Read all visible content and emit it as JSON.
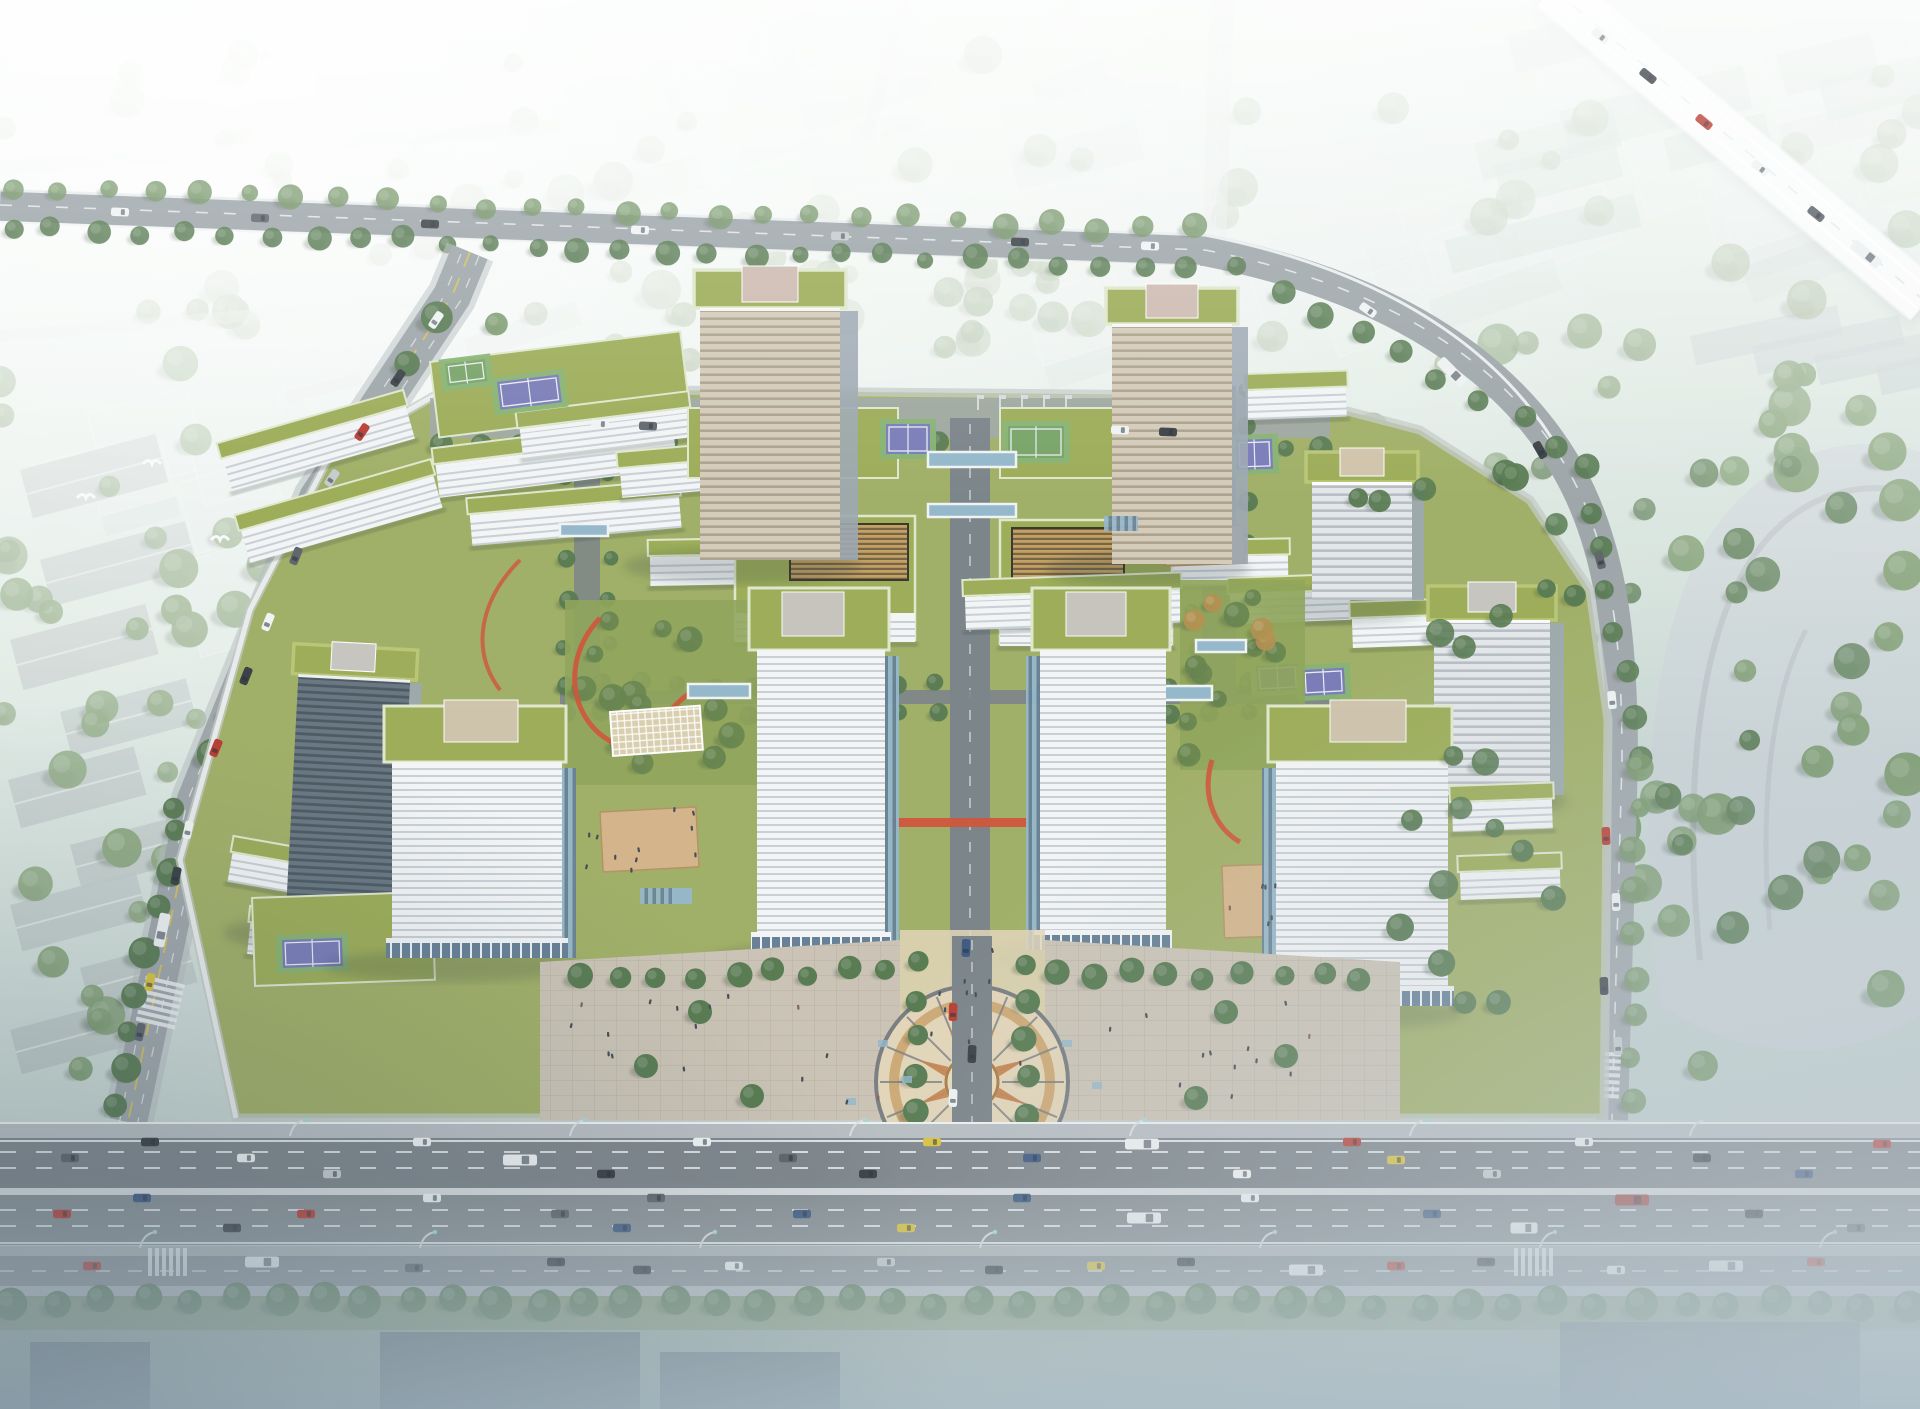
{
  "meta": {
    "description": "Aerial architectural rendering of a green-roofed research campus: two striped high-rise towers at the north, four cubic office blocks around a central paved plaza with a circular compass pattern, low-rise white banded buildings with rooftop lawns, sports courts and red jogging tracks, surrounded by tree-lined roads, a hazy white low-rise city, an elevated expressway at the top right and a wide multi-lane boulevard full of traffic across the bottom"
  },
  "palette": {
    "bgTop": "#e9f3ee",
    "bgMid": "#d3e2da",
    "bgLow": "#c3d2cf",
    "hazeWhite": "#ffffff",
    "boxFill": "#dfe9e8",
    "boxEdge": "#f6fafa",
    "boxShade": "#b9c6c7",
    "gableFill": "#b4bfbe",
    "glassSlab": "#aec6bb",
    "treeBg": "#8aa57d",
    "treeMid": "#6f9160",
    "treeDark": "#4e7247",
    "treeOlive": "#7e9a55",
    "treeOrange": "#b08a46",
    "fieldGreen": "#c7d8c0",
    "roadFaint": "#cdd6d4",
    "roadMain": "#9aa1a6",
    "roadDark": "#7e868c",
    "asphaltA": "#787f86",
    "asphaltB": "#82898f",
    "median": "#abb2b7",
    "sidewalk": "#b5bbc0",
    "frontage": "#868d93",
    "laneWhite": "#e9eef2",
    "laneYellow": "#d9c04b",
    "rail": "#f2f5f6",
    "campusGreen": "#9cab5e",
    "roofGreen": "#97a84e",
    "roofGreenL": "#b6c36e",
    "fascia": "#dfe7cb",
    "lawn": "#8aa051",
    "gardenDark": "#5e7c44",
    "slabWhite": "#f3f5f7",
    "slabShadow": "#c6cdd4",
    "slabSide": "#d8dde2",
    "towerTanA": "#d3c8b6",
    "towerTanB": "#a99c88",
    "towerSide": "#97a2ae",
    "darkA": "#5f6e7a",
    "darkB": "#424f59",
    "towerGreyA": "#e4e7ea",
    "towerGreyB": "#b3bac2",
    "penthousePink": "#cbb7ad",
    "penthouseGrey": "#c5c2bd",
    "penthouseTan": "#cfc0a8",
    "glassBlue": "#8fb3c9",
    "glassDark": "#5e7890",
    "mullion": "#eef4f8",
    "courtBlue": "#7173b5",
    "courtGreen": "#7fae6c",
    "courtLine": "#e8ecf2",
    "deckTan": "#d3b084",
    "trackRed": "#cd4a2c",
    "plazaBase": "#c9c0b2",
    "plazaLight": "#e2d3b6",
    "ringBrown": "#a8743c",
    "ringTan": "#c99f66",
    "ringDark": "#70767a",
    "star": "#c27b45",
    "centerDisc": "#e6d8ba",
    "axisGrey": "#747c83",
    "louvGold": "#c29a58",
    "louvDark": "#6d5a39",
    "latticeTan": "#d8cbaa",
    "fogBlue": "#b7c5ce",
    "waterDark": "#4e5c66",
    "carWhite": "#f0f3f5",
    "carSilver": "#c3c9ce",
    "carBlack": "#2e343a",
    "carGrey": "#555c63",
    "carRed": "#b63026",
    "carBlue": "#33507c",
    "taxi": "#d8bf35",
    "busWhite": "#eef1f3",
    "busRed": "#9c3a35",
    "birdWhite": "#fbfdfd",
    "peopleDark": "#39414a",
    "peopleWarm": "#7c5a42"
  },
  "scene": {
    "counts": {
      "towers": 5,
      "cubes": 4,
      "sport_courts": 7,
      "bg_buildings": 54,
      "bg_trees": 60,
      "woods_left_trees": 52,
      "woods_right_trees": 62,
      "highway_trees": 44,
      "highway_upper_lanes": 3,
      "highway_lower_lanes": 3,
      "frontage_lanes": 2,
      "lamp_posts": 7
    },
    "vehicles": [
      {
        "x": 70,
        "y": 1158,
        "r": 0,
        "c": "carGrey"
      },
      {
        "x": 150,
        "y": 1142,
        "r": 0,
        "c": "carBlack"
      },
      {
        "x": 246,
        "y": 1158,
        "r": 0,
        "c": "carWhite"
      },
      {
        "x": 332,
        "y": 1174,
        "r": 0,
        "c": "carSilver"
      },
      {
        "x": 422,
        "y": 1142,
        "r": 0,
        "c": "carWhite"
      },
      {
        "x": 520,
        "y": 1160,
        "r": 0,
        "c": "busWhite",
        "t": "bus"
      },
      {
        "x": 606,
        "y": 1174,
        "r": 0,
        "c": "carBlack"
      },
      {
        "x": 702,
        "y": 1142,
        "r": 0,
        "c": "carWhite"
      },
      {
        "x": 788,
        "y": 1158,
        "r": 0,
        "c": "carGrey"
      },
      {
        "x": 868,
        "y": 1174,
        "r": 0,
        "c": "carBlack"
      },
      {
        "x": 932,
        "y": 1142,
        "r": 0,
        "c": "taxi"
      },
      {
        "x": 1032,
        "y": 1158,
        "r": 0,
        "c": "carBlue"
      },
      {
        "x": 1142,
        "y": 1144,
        "r": 0,
        "c": "busWhite",
        "t": "bus"
      },
      {
        "x": 1242,
        "y": 1174,
        "r": 0,
        "c": "carWhite"
      },
      {
        "x": 1352,
        "y": 1142,
        "r": 0,
        "c": "carRed"
      },
      {
        "x": 1396,
        "y": 1160,
        "r": 0,
        "c": "taxi"
      },
      {
        "x": 1492,
        "y": 1174,
        "r": 0,
        "c": "carSilver"
      },
      {
        "x": 1584,
        "y": 1142,
        "r": 0,
        "c": "carWhite"
      },
      {
        "x": 1702,
        "y": 1158,
        "r": 0,
        "c": "carBlack"
      },
      {
        "x": 1804,
        "y": 1174,
        "r": 0,
        "c": "carBlue"
      },
      {
        "x": 1882,
        "y": 1144,
        "r": 0,
        "c": "carRed"
      },
      {
        "x": 62,
        "y": 1214,
        "r": 0,
        "c": "carRed"
      },
      {
        "x": 142,
        "y": 1198,
        "r": 0,
        "c": "carBlue"
      },
      {
        "x": 232,
        "y": 1228,
        "r": 0,
        "c": "carBlack"
      },
      {
        "x": 306,
        "y": 1214,
        "r": 0,
        "c": "carRed"
      },
      {
        "x": 432,
        "y": 1198,
        "r": 0,
        "c": "carWhite"
      },
      {
        "x": 560,
        "y": 1214,
        "r": 0,
        "c": "carGrey"
      },
      {
        "x": 622,
        "y": 1228,
        "r": 0,
        "c": "carBlue"
      },
      {
        "x": 656,
        "y": 1198,
        "r": 0,
        "c": "carGrey"
      },
      {
        "x": 802,
        "y": 1214,
        "r": 0,
        "c": "carBlue"
      },
      {
        "x": 906,
        "y": 1228,
        "r": 0,
        "c": "taxi"
      },
      {
        "x": 1022,
        "y": 1198,
        "r": 0,
        "c": "carBlue"
      },
      {
        "x": 1144,
        "y": 1218,
        "r": 0,
        "c": "busWhite",
        "t": "bus"
      },
      {
        "x": 1250,
        "y": 1198,
        "r": 0,
        "c": "carWhite"
      },
      {
        "x": 1432,
        "y": 1214,
        "r": 0,
        "c": "carBlue"
      },
      {
        "x": 1524,
        "y": 1228,
        "r": 0,
        "c": "carWhite",
        "t": "truck"
      },
      {
        "x": 1632,
        "y": 1200,
        "r": 0,
        "c": "busRed",
        "t": "bus"
      },
      {
        "x": 1754,
        "y": 1214,
        "r": 0,
        "c": "carBlack"
      },
      {
        "x": 1856,
        "y": 1228,
        "r": 0,
        "c": "carGrey"
      },
      {
        "x": 92,
        "y": 1266,
        "r": 0,
        "c": "carRed"
      },
      {
        "x": 262,
        "y": 1262,
        "r": 0,
        "c": "busWhite",
        "t": "bus"
      },
      {
        "x": 414,
        "y": 1268,
        "r": 0,
        "c": "carGrey"
      },
      {
        "x": 556,
        "y": 1262,
        "r": 0,
        "c": "carBlack"
      },
      {
        "x": 642,
        "y": 1270,
        "r": 0,
        "c": "carBlack"
      },
      {
        "x": 734,
        "y": 1266,
        "r": 0,
        "c": "carWhite"
      },
      {
        "x": 886,
        "y": 1262,
        "r": 0,
        "c": "carSilver"
      },
      {
        "x": 994,
        "y": 1270,
        "r": 0,
        "c": "carBlack"
      },
      {
        "x": 1096,
        "y": 1266,
        "r": 0,
        "c": "taxi"
      },
      {
        "x": 1186,
        "y": 1262,
        "r": 0,
        "c": "carBlack"
      },
      {
        "x": 1306,
        "y": 1270,
        "r": 0,
        "c": "busWhite",
        "t": "bus"
      },
      {
        "x": 1396,
        "y": 1266,
        "r": 0,
        "c": "carRed"
      },
      {
        "x": 1486,
        "y": 1262,
        "r": 0,
        "c": "carBlack"
      },
      {
        "x": 1616,
        "y": 1270,
        "r": 0,
        "c": "carWhite"
      },
      {
        "x": 1726,
        "y": 1266,
        "r": 0,
        "c": "busWhite",
        "t": "bus"
      },
      {
        "x": 1816,
        "y": 1262,
        "r": 0,
        "c": "carRed"
      },
      {
        "x": 436,
        "y": 320,
        "r": 124,
        "c": "carWhite"
      },
      {
        "x": 398,
        "y": 378,
        "r": 124,
        "c": "carBlack"
      },
      {
        "x": 362,
        "y": 432,
        "r": 124,
        "c": "carRed"
      },
      {
        "x": 332,
        "y": 478,
        "r": 124,
        "c": "carSilver"
      },
      {
        "x": 296,
        "y": 556,
        "r": 112,
        "c": "carGrey"
      },
      {
        "x": 268,
        "y": 622,
        "r": 112,
        "c": "carWhite"
      },
      {
        "x": 246,
        "y": 676,
        "r": 112,
        "c": "carBlack"
      },
      {
        "x": 216,
        "y": 748,
        "r": 112,
        "c": "carRed"
      },
      {
        "x": 188,
        "y": 830,
        "r": 102,
        "c": "carWhite"
      },
      {
        "x": 176,
        "y": 876,
        "r": 102,
        "c": "carBlack"
      },
      {
        "x": 162,
        "y": 930,
        "r": 102,
        "c": "busWhite",
        "t": "bus"
      },
      {
        "x": 150,
        "y": 982,
        "r": 102,
        "c": "taxi"
      },
      {
        "x": 140,
        "y": 1032,
        "r": 102,
        "c": "carGrey"
      },
      {
        "x": 120,
        "y": 212,
        "r": 2,
        "c": "carWhite"
      },
      {
        "x": 260,
        "y": 218,
        "r": 2,
        "c": "carGrey"
      },
      {
        "x": 430,
        "y": 224,
        "r": 2,
        "c": "carBlack"
      },
      {
        "x": 640,
        "y": 230,
        "r": 2,
        "c": "carWhite"
      },
      {
        "x": 840,
        "y": 236,
        "r": 2,
        "c": "carSilver"
      },
      {
        "x": 1020,
        "y": 242,
        "r": 2,
        "c": "carBlack"
      },
      {
        "x": 1150,
        "y": 246,
        "r": 2,
        "c": "carWhite"
      },
      {
        "x": 1368,
        "y": 310,
        "r": 35,
        "c": "carWhite"
      },
      {
        "x": 1452,
        "y": 372,
        "r": 45,
        "c": "busWhite",
        "t": "bus"
      },
      {
        "x": 1540,
        "y": 450,
        "r": 60,
        "c": "carBlack"
      },
      {
        "x": 1600,
        "y": 560,
        "r": 75,
        "c": "carGrey"
      },
      {
        "x": 1612,
        "y": 700,
        "r": 85,
        "c": "carWhite"
      },
      {
        "x": 1606,
        "y": 836,
        "r": 88,
        "c": "carRed"
      },
      {
        "x": 1616,
        "y": 902,
        "r": 88,
        "c": "carWhite"
      },
      {
        "x": 1604,
        "y": 986,
        "r": 88,
        "c": "carBlack"
      },
      {
        "x": 1618,
        "y": 1046,
        "r": 88,
        "c": "carSilver"
      },
      {
        "x": 953,
        "y": 1012,
        "r": 92,
        "c": "carRed"
      },
      {
        "x": 972,
        "y": 1054,
        "r": 92,
        "c": "carBlack"
      },
      {
        "x": 953,
        "y": 1098,
        "r": 92,
        "c": "carWhite"
      },
      {
        "x": 966,
        "y": 948,
        "r": 92,
        "c": "carBlue"
      },
      {
        "x": 1600,
        "y": 36,
        "r": 39,
        "c": "carWhite"
      },
      {
        "x": 1648,
        "y": 76,
        "r": 39,
        "c": "carBlack"
      },
      {
        "x": 1704,
        "y": 122,
        "r": 39,
        "c": "carRed"
      },
      {
        "x": 1760,
        "y": 168,
        "r": 39,
        "c": "carWhite"
      },
      {
        "x": 1816,
        "y": 214,
        "r": 39,
        "c": "carGrey"
      },
      {
        "x": 1866,
        "y": 254,
        "r": 39,
        "c": "busWhite",
        "t": "bus"
      },
      {
        "x": 600,
        "y": 424,
        "r": 2,
        "c": "carWhite"
      },
      {
        "x": 648,
        "y": 426,
        "r": 2,
        "c": "carGrey"
      },
      {
        "x": 1120,
        "y": 430,
        "r": 2,
        "c": "carWhite"
      },
      {
        "x": 1168,
        "y": 432,
        "r": 2,
        "c": "carBlack"
      }
    ],
    "people_zones": [
      {
        "x": 560,
        "y": 990,
        "w": 320,
        "h": 110,
        "n": 16
      },
      {
        "x": 1060,
        "y": 990,
        "w": 280,
        "h": 110,
        "n": 12
      },
      {
        "x": 912,
        "y": 946,
        "w": 110,
        "h": 170,
        "n": 10
      },
      {
        "x": 578,
        "y": 824,
        "w": 92,
        "h": 56,
        "n": 6
      },
      {
        "x": 1222,
        "y": 868,
        "w": 66,
        "h": 70,
        "n": 6
      },
      {
        "x": 628,
        "y": 806,
        "w": 80,
        "h": 50,
        "n": 5
      }
    ],
    "birds": [
      [
        86,
        498
      ],
      [
        152,
        464
      ],
      [
        220,
        540
      ],
      [
        262,
        58
      ]
    ],
    "flag_rows": [
      {
        "x": 548,
        "y": 404,
        "n": 5,
        "dx": 20
      },
      {
        "x": 978,
        "y": 410,
        "n": 5,
        "dx": 22
      }
    ]
  }
}
